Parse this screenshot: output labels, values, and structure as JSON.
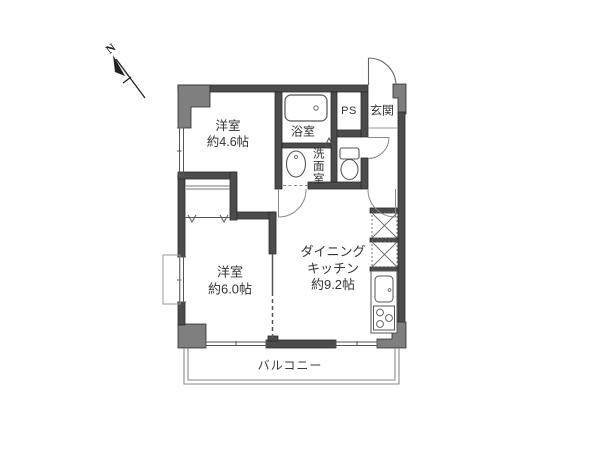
{
  "floorplan": {
    "compass": {
      "north_label": "N"
    },
    "rooms": {
      "bedroom_small": {
        "name": "洋室",
        "size": "約4.6帖"
      },
      "bedroom_large": {
        "name": "洋室",
        "size": "約6.0帖"
      },
      "dining_kitchen": {
        "name_line1": "ダイニング",
        "name_line2": "キッチン",
        "size": "約9.2帖"
      },
      "bathroom": {
        "name": "浴室"
      },
      "washroom": {
        "name": "洗面室"
      },
      "pipe_space": {
        "name": "PS"
      },
      "entrance": {
        "name": "玄関"
      },
      "balcony": {
        "name": "バルコニー"
      }
    },
    "colors": {
      "wall": "#4c4c4c",
      "column": "#7f7f7f",
      "line": "#555555",
      "light_line": "#999999",
      "text": "#333333",
      "background": "#ffffff"
    }
  }
}
